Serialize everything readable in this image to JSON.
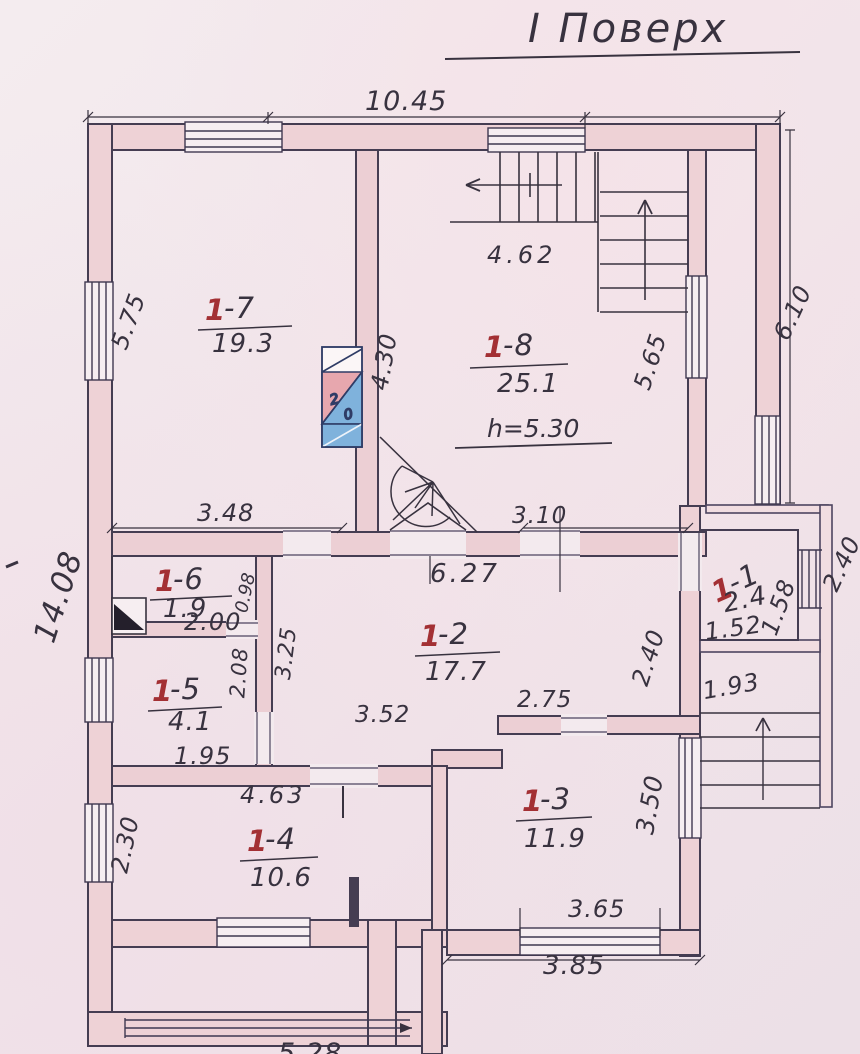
{
  "title": "І Поверх",
  "rooms": [
    {
      "prefix": "1",
      "suffix": "-1",
      "area": "2.4"
    },
    {
      "prefix": "1",
      "suffix": "-2",
      "area": "17.7"
    },
    {
      "prefix": "1",
      "suffix": "-3",
      "area": "11.9"
    },
    {
      "prefix": "1",
      "suffix": "-4",
      "area": "10.6"
    },
    {
      "prefix": "1",
      "suffix": "-5",
      "area": "4.1"
    },
    {
      "prefix": "1",
      "suffix": "-6",
      "area": "1.9"
    },
    {
      "prefix": "1",
      "suffix": "-7",
      "area": "19.3"
    },
    {
      "prefix": "1",
      "suffix": "-8",
      "area": "25.1",
      "note": "h=5.30"
    }
  ],
  "stove": {
    "top_mark": "2",
    "bottom_mark": "0"
  },
  "dimensions": {
    "top_width": "10.45",
    "stair_flight": "4.62",
    "room7_left": "5.75",
    "left_total": "14.08",
    "gallery_right": "6.10",
    "room8_right": "5.65",
    "room8_wall": "4.30",
    "mid_wall_left": "3.48",
    "mid_wall_right": "3.10",
    "corridor": "6.27",
    "room6_width": "2.00",
    "room6_depth": "0.98",
    "partition": "3.25",
    "room5_depth": "2.08",
    "room5_width": "1.95",
    "room2_right": "2.40",
    "annex_depth": "2.40",
    "room1_width": "1.52",
    "room1_depth": "1.58",
    "lobby_width": "1.93",
    "room3_top": "2.75",
    "room2_bottom": "3.52",
    "room4_top": "4.63",
    "room4_left": "2.30",
    "room3_right": "3.50",
    "bottom_window": "3.65",
    "bottom_right": "3.85",
    "bottom_partial": "5.28"
  },
  "colors": {
    "ink": "#38323f",
    "wall_fill": "#eed2d6",
    "red": "#a33034",
    "stove_pink": "#e7a7ae",
    "stove_blue": "#7fb2dc"
  }
}
